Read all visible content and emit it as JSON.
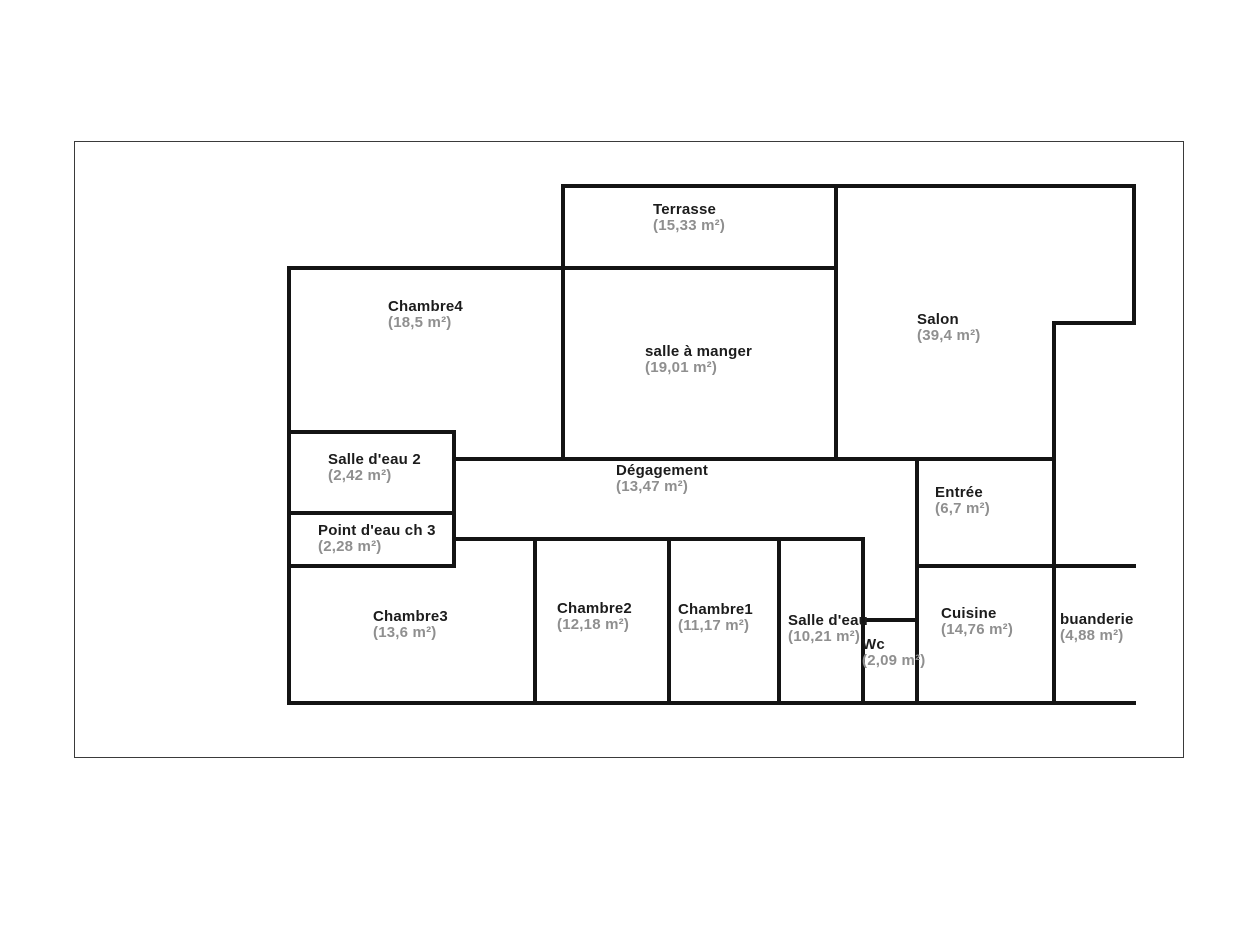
{
  "plan": {
    "rooms": [
      {
        "id": "terrasse",
        "name": "Terrasse",
        "area": "(15,33 m²)"
      },
      {
        "id": "chambre4",
        "name": "Chambre4",
        "area": "(18,5 m²)"
      },
      {
        "id": "salle-a-manger",
        "name": "salle à manger",
        "area": "(19,01 m²)"
      },
      {
        "id": "salon",
        "name": "Salon",
        "area": "(39,4 m²)"
      },
      {
        "id": "salle-deau-2",
        "name": "Salle d'eau 2",
        "area": "(2,42 m²)"
      },
      {
        "id": "point-deau-ch-3",
        "name": "Point d'eau ch 3",
        "area": "(2,28 m²)"
      },
      {
        "id": "degagement",
        "name": "Dégagement",
        "area": "(13,47 m²)"
      },
      {
        "id": "entree",
        "name": "Entrée",
        "area": "(6,7 m²)"
      },
      {
        "id": "chambre3",
        "name": "Chambre3",
        "area": "(13,6 m²)"
      },
      {
        "id": "chambre2",
        "name": "Chambre2",
        "area": "(12,18 m²)"
      },
      {
        "id": "chambre1",
        "name": "Chambre1",
        "area": "(11,17 m²)"
      },
      {
        "id": "salle-deau",
        "name": "Salle d'eau",
        "area": "(10,21 m²)"
      },
      {
        "id": "wc",
        "name": "Wc",
        "area": "(2,09 m²)"
      },
      {
        "id": "cuisine",
        "name": "Cuisine",
        "area": "(14,76 m²)"
      },
      {
        "id": "buanderie",
        "name": "buanderie",
        "area": "(4,88 m²)"
      }
    ],
    "colors": {
      "wall": "#141414",
      "frame": "#3a3a3a",
      "room_name": "#1c1c1c",
      "room_area": "#8f8f8f",
      "background": "#ffffff"
    }
  }
}
